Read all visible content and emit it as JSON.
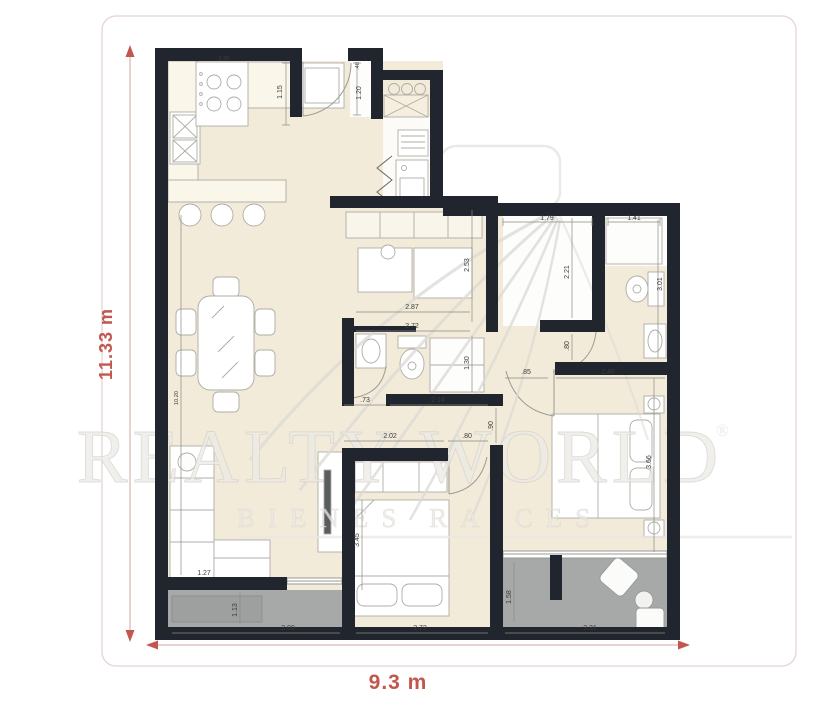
{
  "watermark": {
    "brand": "REALTY WORLD",
    "registered_mark": "®",
    "tagline": "BIENES RAICES"
  },
  "overall": {
    "height_label": "11.33 m",
    "width_label": "9.3 m"
  },
  "colors": {
    "accent": "#c2574e",
    "wall": "#21252d",
    "floor": "#f3ebd9",
    "counter": "#fbf6ea",
    "balcony": "#a7a9a8",
    "watermark_gray": "#e9e8e4",
    "border_pink": "#e6d3d2"
  },
  "measurements": {
    "stove_width": "2.30",
    "kitchen_counter_depth": "1.15",
    "entry_door_width": ".40",
    "entry_closet_depth": "1.20",
    "hall_width": "1.79",
    "shower_width": "1.41",
    "study_depth": "2.53",
    "closet_hall_depth": "2.21",
    "bath2_length": "3.01",
    "study_width": "2.87",
    "bath1_width": "2.72",
    "bath1_depth": "1.30",
    "closet_hall_door": ".80",
    "bed2_door_gap": ".85",
    "bed2_width": "2.46",
    "bath1_door": ".73",
    "bath1_wall": "2.14",
    "living_length": "10.20",
    "bed1_wall_top": "2.02",
    "bed1_door": ".80",
    "bed1_passage": ".90",
    "bed1_length": "3.45",
    "bed2_length": "3.66",
    "sofa_wall": "1.27",
    "balcony1_depth": "1.13",
    "balcony1_width": "2.00",
    "bed1_width": "2.72",
    "balcony2_depth": "1.58",
    "balcony2_width": "3.31"
  }
}
